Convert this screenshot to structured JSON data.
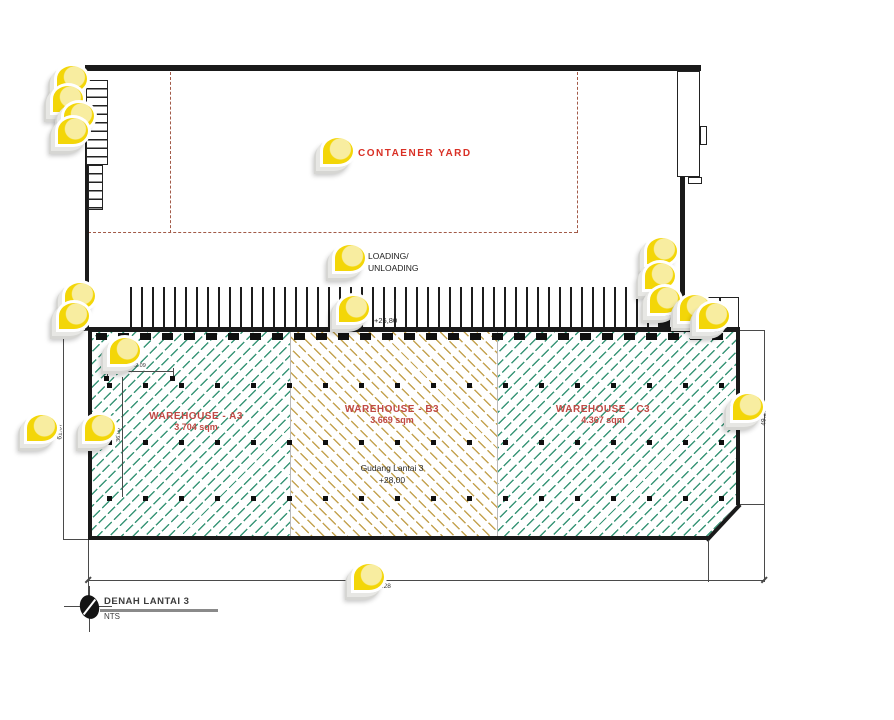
{
  "plan": {
    "container_yard_label": "CONTAENER YARD",
    "loading_label_line1": "LOADING/",
    "loading_label_line2": "UNLOADING",
    "dock_level": "+26,80",
    "warehouses": [
      {
        "name": "WAREHOUSE - A3",
        "area": "3.704 sqm"
      },
      {
        "name": "WAREHOUSE - B3",
        "area": "3.669 sqm"
      },
      {
        "name": "WAREHOUSE - C3",
        "area": "4.367 sqm"
      }
    ],
    "floor_note_line1": "Gudang Lantai 3",
    "floor_note_line2": "+28,00",
    "dimensions": {
      "bottom": "181.28",
      "left": "61.07",
      "right": "49.28",
      "inner_width": "12.09",
      "inner_height": "36.00"
    },
    "title": "DENAH LANTAI 3",
    "scale": "NTS"
  },
  "colors": {
    "marker_yellow": "#f3d608",
    "marker_light": "#f8eda0",
    "yard_red": "#d93025",
    "warehouse_red": "#c04a45",
    "hatch_green": "#3a9678",
    "hatch_tan": "#c4a351",
    "dash_brown": "#a25a48"
  },
  "markers": [
    {
      "x": 72,
      "y": 79
    },
    {
      "x": 68,
      "y": 99
    },
    {
      "x": 79,
      "y": 116
    },
    {
      "x": 73,
      "y": 131
    },
    {
      "x": 80,
      "y": 296
    },
    {
      "x": 74,
      "y": 316
    },
    {
      "x": 125,
      "y": 351
    },
    {
      "x": 100,
      "y": 428
    },
    {
      "x": 42,
      "y": 428
    },
    {
      "x": 338,
      "y": 151
    },
    {
      "x": 350,
      "y": 258
    },
    {
      "x": 354,
      "y": 309
    },
    {
      "x": 369,
      "y": 577
    },
    {
      "x": 662,
      "y": 251
    },
    {
      "x": 660,
      "y": 276
    },
    {
      "x": 665,
      "y": 300
    },
    {
      "x": 695,
      "y": 308
    },
    {
      "x": 714,
      "y": 316
    },
    {
      "x": 748,
      "y": 407
    }
  ]
}
